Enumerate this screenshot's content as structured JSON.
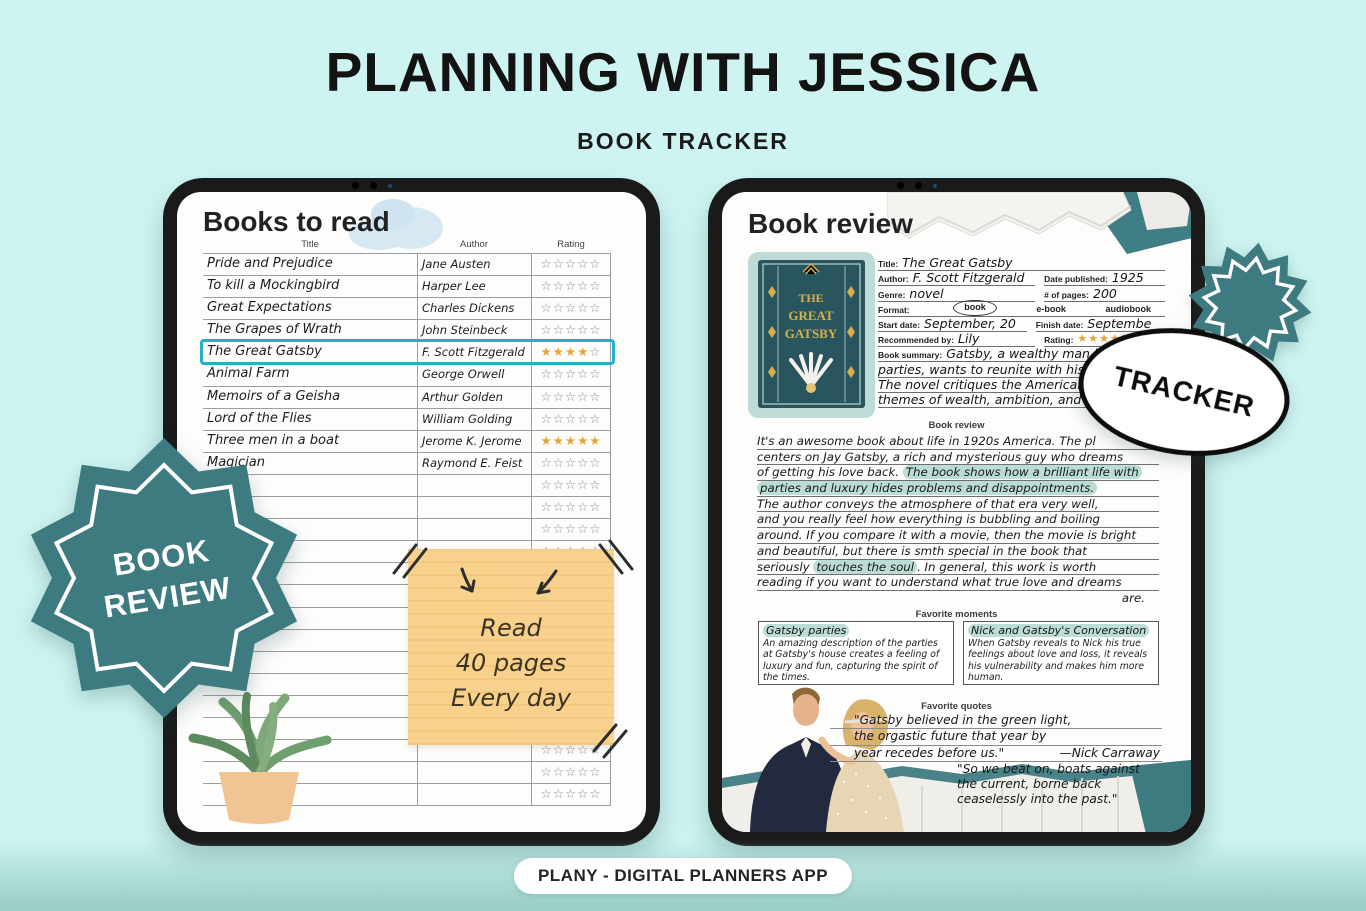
{
  "page": {
    "title": "PLANNING WITH JESSICA",
    "subtitle": "BOOK TRACKER",
    "footer": "PLANY - DIGITAL PLANNERS APP"
  },
  "colors": {
    "background": "#cdf4f0",
    "teal_badge": "#3d7b81",
    "row_highlight_border": "#27aec8",
    "star_gold": "#e7a43a",
    "sticky_note": "#f8d18c",
    "text_highlight": "#bcdcd6"
  },
  "badges": {
    "book_review_line1": "BOOK",
    "book_review_line2": "REVIEW",
    "tracker": "TRACKER"
  },
  "books_page": {
    "title": "Books to read",
    "columns": [
      "Title",
      "Author",
      "Rating"
    ],
    "rows": [
      {
        "title": "Pride and Prejudice",
        "author": "Jane Austen",
        "rating": 0,
        "highlight": false
      },
      {
        "title": "To kill a Mockingbird",
        "author": "Harper Lee",
        "rating": 0,
        "highlight": false
      },
      {
        "title": "Great Expectations",
        "author": "Charles Dickens",
        "rating": 0,
        "highlight": false
      },
      {
        "title": "The Grapes of Wrath",
        "author": "John Steinbeck",
        "rating": 0,
        "highlight": false
      },
      {
        "title": "The Great Gatsby",
        "author": "F. Scott Fitzgerald",
        "rating": 4,
        "highlight": true
      },
      {
        "title": "Animal Farm",
        "author": "George Orwell",
        "rating": 0,
        "highlight": false
      },
      {
        "title": "Memoirs of a Geisha",
        "author": "Arthur Golden",
        "rating": 0,
        "highlight": false
      },
      {
        "title": "Lord of the Flies",
        "author": "William Golding",
        "rating": 0,
        "highlight": false
      },
      {
        "title": "Three men in a boat",
        "author": "Jerome K. Jerome",
        "rating": 5,
        "highlight": false
      },
      {
        "title": "Magician",
        "author": "Raymond E. Feist",
        "rating": 0,
        "highlight": false
      }
    ],
    "empty_rows": 15,
    "stars_max": 5,
    "sticky_note": {
      "lines": [
        "Read",
        "40 pages",
        "Every day"
      ]
    }
  },
  "review_page": {
    "title": "Book review",
    "form": {
      "title_label": "Title:",
      "title_value": "The Great Gatsby",
      "author_label": "Author:",
      "author_value": "F. Scott Fitzgerald",
      "date_published_label": "Date published:",
      "date_published_value": "1925",
      "genre_label": "Genre:",
      "genre_value": "novel",
      "pages_label": "# of pages:",
      "pages_value": "200",
      "format_label": "Format:",
      "format_options": [
        "book",
        "e-book",
        "audiobook"
      ],
      "format_selected": "book",
      "start_label": "Start date:",
      "start_value": "September, 20",
      "finish_label": "Finish date:",
      "finish_value": "Septembe",
      "recommended_label": "Recommended by:",
      "recommended_value": "Lily",
      "rating_label": "Rating:",
      "rating": 4,
      "summary_label": "Book summary:"
    },
    "summary_lines": [
      "Gatsby, a wealthy man known",
      "parties, wants to reunite with his f",
      "The novel critiques the American Drea",
      "themes of wealth, ambition, and disil"
    ],
    "section_review": "Book review",
    "review_lines": [
      {
        "segs": [
          {
            "t": "It's an awesome book about life in 1920s America. The pl",
            "h": false
          }
        ]
      },
      {
        "segs": [
          {
            "t": "centers on Jay Gatsby, a rich and mysterious guy who dreams",
            "h": false
          }
        ]
      },
      {
        "segs": [
          {
            "t": "of getting his love back. ",
            "h": false
          },
          {
            "t": "The book shows how a brilliant life with",
            "h": true
          }
        ]
      },
      {
        "segs": [
          {
            "t": "parties and luxury hides problems and disappointments.",
            "h": true
          }
        ]
      },
      {
        "segs": [
          {
            "t": "The author conveys the atmosphere of that era very well,",
            "h": false
          }
        ]
      },
      {
        "segs": [
          {
            "t": "and you really feel how everything is bubbling and boiling",
            "h": false
          }
        ]
      },
      {
        "segs": [
          {
            "t": "around. If you compare it with a movie, then the movie is bright",
            "h": false
          }
        ]
      },
      {
        "segs": [
          {
            "t": "and beautiful, but there is smth special in the book that",
            "h": false
          }
        ]
      },
      {
        "segs": [
          {
            "t": "seriously ",
            "h": false
          },
          {
            "t": "touches the soul",
            "h": true
          },
          {
            "t": ". In general, this work is worth",
            "h": false
          }
        ]
      },
      {
        "segs": [
          {
            "t": "reading if you want to understand what true love and dreams",
            "h": false
          }
        ]
      },
      {
        "segs": [
          {
            "t": "are.",
            "h": false
          }
        ],
        "align": "right"
      }
    ],
    "section_moments": "Favorite moments",
    "moments": [
      {
        "title": "Gatsby parties",
        "text": "An amazing description of the parties at Gatsby's house creates a feeling of luxury and fun, capturing the spirit of the times."
      },
      {
        "title": "Nick and Gatsby's Conversation",
        "text": "When Gatsby reveals to Nick his true feelings about love and loss, it reveals his vulnerability and makes him more human."
      }
    ],
    "section_quotes": "Favorite quotes",
    "quotes": [
      {
        "lines": [
          "\"Gatsby believed in the green light,",
          "the orgastic future that year by",
          "year recedes before us.\""
        ],
        "attribution": "—Nick Carraway"
      },
      {
        "lines": [
          "\"So we beat on, boats against",
          "the current, borne back",
          "ceaselessly into the past.\""
        ]
      }
    ]
  }
}
